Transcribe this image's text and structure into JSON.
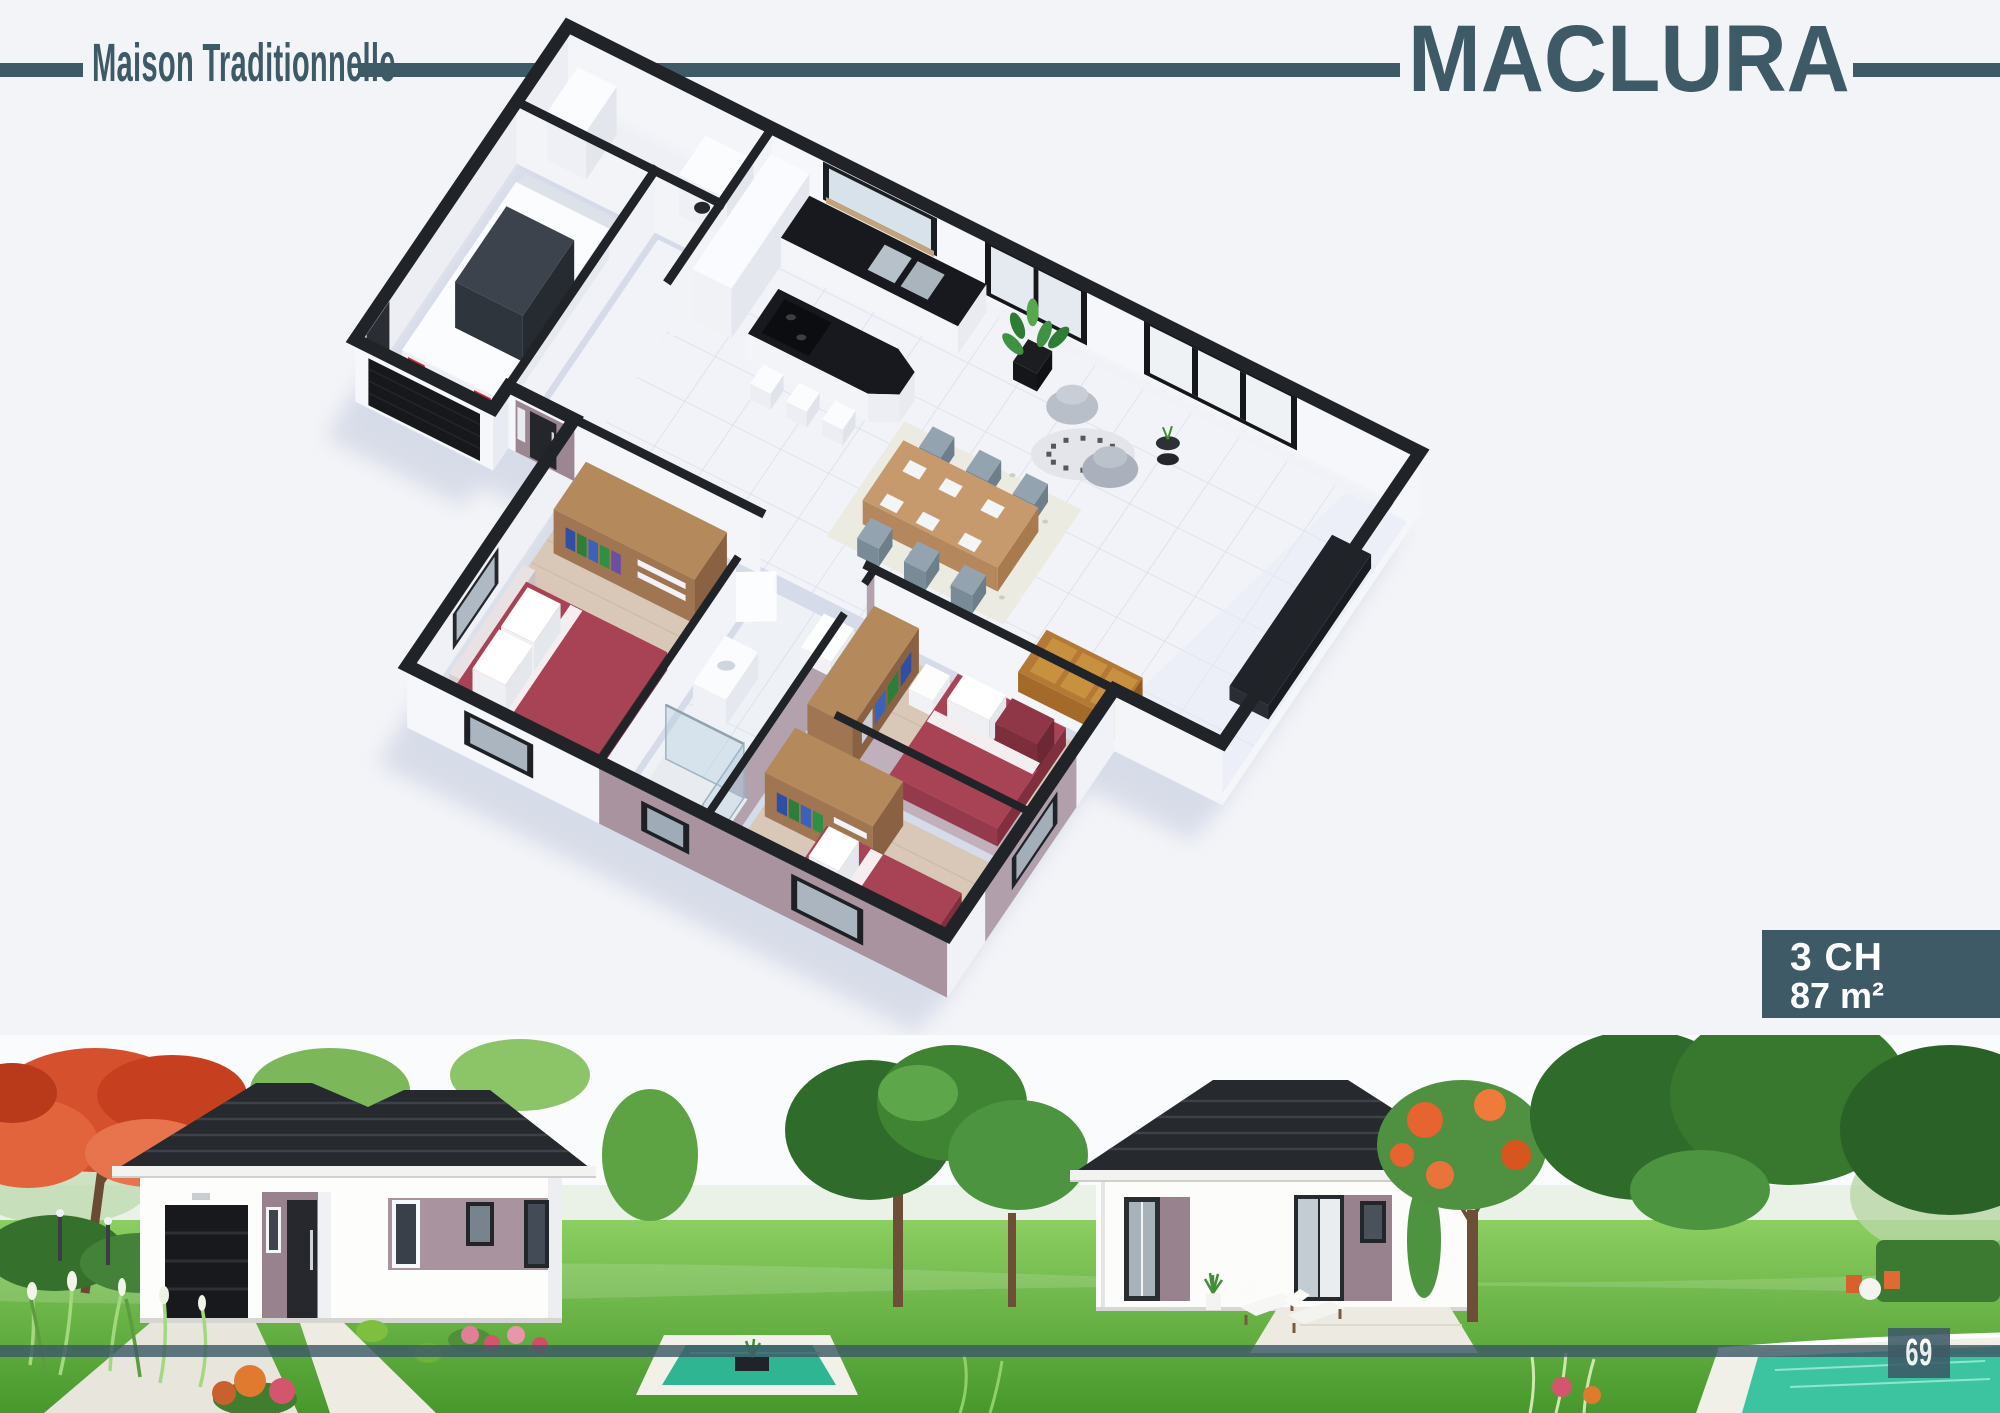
{
  "header": {
    "category_label": "Maison Traditionnelle",
    "model_name": "MACLURA"
  },
  "spec_badge": {
    "bedrooms": "3 CH",
    "area": "87 m²"
  },
  "footer": {
    "page_number": "69"
  },
  "colors": {
    "brand_teal": "#3d5a66",
    "background": "#f3f4f8",
    "cap_dark": "#202327",
    "wall_white": "#f6f7fa",
    "accent_mauve": "#9b8691",
    "plan_mauve": "#b3a2ae",
    "bed_red": "#a84355",
    "wood": "#b48a5c",
    "counter_black": "#17191e",
    "floor_tile": "#f2f3f8",
    "floor_wood": "#d9c8b8",
    "roof_dark": "#26292e",
    "grass_green": "#5fae3f",
    "water_teal": "#2fb592",
    "flower_red": "#d5502d"
  }
}
